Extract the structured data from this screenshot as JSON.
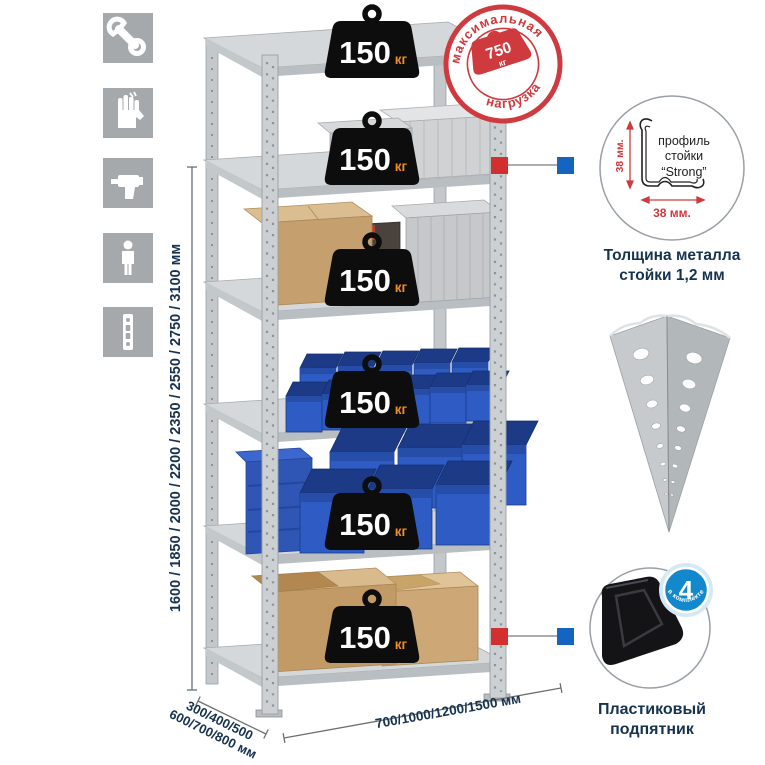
{
  "illustration": {
    "shelf_load": {
      "value": "150",
      "unit": "кг"
    },
    "max_load_stamp": {
      "arc_top": "максимальная",
      "arc_bottom": "нагрузка",
      "value": "750",
      "unit": "кг"
    },
    "height_options": "1600 / 1850 / 2000 / 2200 / 2350 / 2550 / 2750 / 3100 мм",
    "depth_options_line1": "300/400/500",
    "depth_options_line2": "600/700/800 мм",
    "width_options": "700/1000/1200/1500 мм"
  },
  "profile_detail": {
    "label_line1": "профиль",
    "label_line2": "стойки",
    "label_line3": "“Strong”",
    "dim_vertical": "38 мм.",
    "dim_horizontal": "38 мм.",
    "caption_line1": "Толщина металла",
    "caption_line2": "стойки 1,2 мм"
  },
  "foot_detail": {
    "badge_value": "4",
    "badge_arc_text": "в комплекте",
    "caption_line1": "Пластиковый",
    "caption_line2": "подпятник"
  },
  "side_icons": {
    "items": [
      "wrench",
      "gloves",
      "drill",
      "person",
      "rack-post"
    ]
  },
  "colors": {
    "accent_red": "#cf3a3e",
    "navy_text": "#16324f",
    "bin_blue": "#2e5cc4",
    "connector_red": "#d32f2f",
    "connector_blue": "#1565c0",
    "icon_tile_gray": "#a6a9ac",
    "metal_gray": "#ccd0d3"
  }
}
